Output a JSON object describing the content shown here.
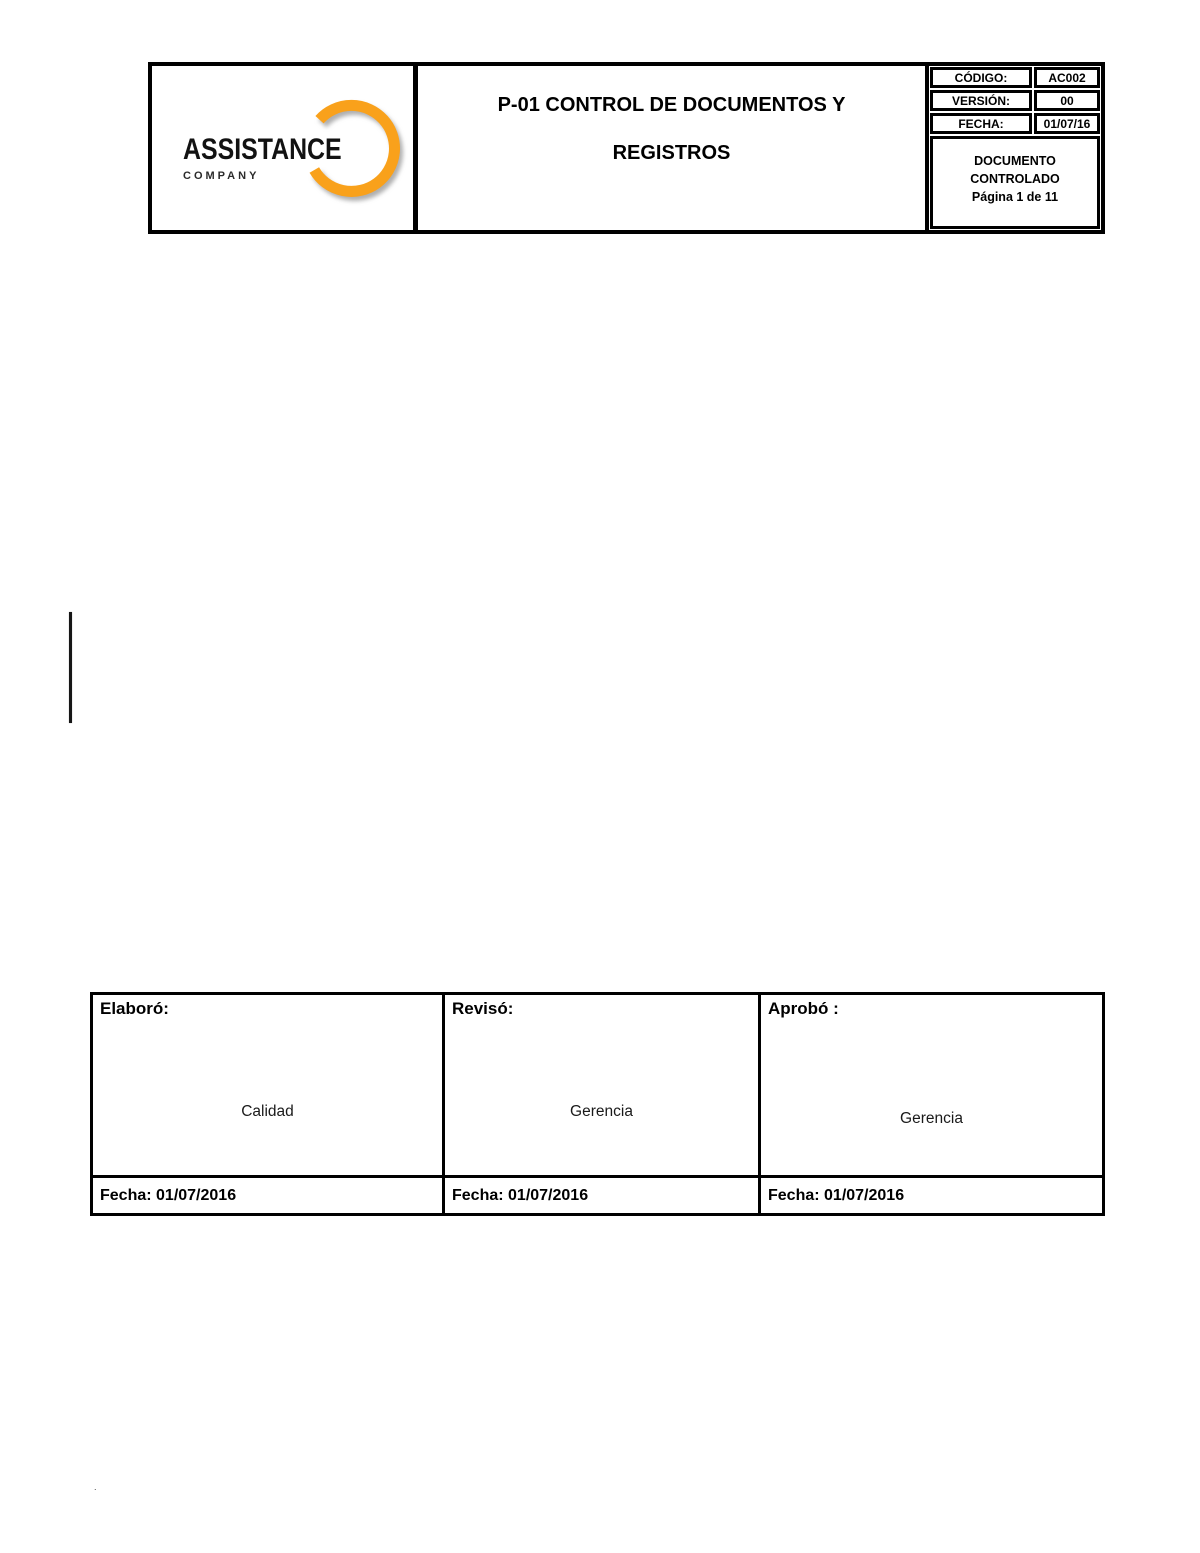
{
  "header": {
    "logo": {
      "company_name": "ASSISTANCE",
      "company_subtitle": "COMPANY"
    },
    "title": {
      "line1": "P-01 CONTROL DE DOCUMENTOS Y",
      "line2": "REGISTROS"
    },
    "meta": {
      "rows": [
        {
          "label": "CÓDIGO:",
          "value": "AC002"
        },
        {
          "label": "VERSIÓN:",
          "value": "00"
        },
        {
          "label": "FECHA:",
          "value": "01/07/16"
        }
      ],
      "note": {
        "line1": "DOCUMENTO",
        "line2": "CONTROLADO",
        "line3": "Página 1 de 11"
      }
    }
  },
  "signoff": {
    "columns": [
      {
        "role": "Elaboró:",
        "name": "Calidad",
        "date": "Fecha: 01/07/2016"
      },
      {
        "role": "Revisó:",
        "name": "Gerencia",
        "date": "Fecha: 01/07/2016"
      },
      {
        "role": "Aprobó :",
        "name": "Gerencia",
        "date": "Fecha: 01/07/2016"
      }
    ]
  },
  "stray": {
    "dot": "."
  },
  "colors": {
    "accent_orange": "#F9A11B",
    "ink": "#000000"
  }
}
